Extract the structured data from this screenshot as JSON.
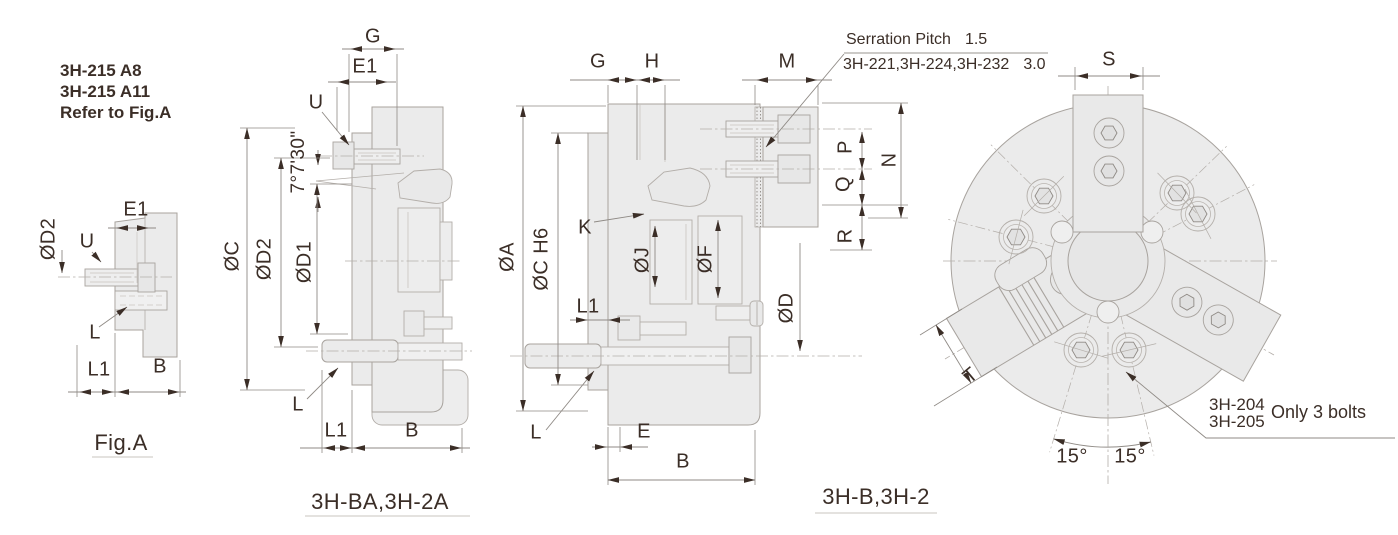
{
  "colors": {
    "ink": "#3b2e27",
    "body_fill": "#ebebeb",
    "outline": "#a8a39e",
    "dim_line": "#8f8a85"
  },
  "note_block": {
    "line1": "3H-215 A8",
    "line2": "3H-215 A11",
    "line3": "Refer to Fig.A"
  },
  "fig_a": {
    "caption": "Fig.A",
    "d2": "ØD2",
    "u": "U",
    "e1": "E1",
    "l": "L",
    "l1": "L1",
    "b": "B"
  },
  "fig_ba": {
    "caption": "3H-BA,3H-2A",
    "g": "G",
    "e1": "E1",
    "u": "U",
    "taper_angle": "7°7'30\"",
    "c": "ØC",
    "d2": "ØD2",
    "d1": "ØD1",
    "l": "L",
    "l1": "L1",
    "b": "B"
  },
  "fig_b": {
    "caption": "3H-B,3H-2",
    "g": "G",
    "h": "H",
    "m": "M",
    "k": "K",
    "a": "ØA",
    "c_h6": "ØC H6",
    "l1": "L1",
    "j": "ØJ",
    "f": "ØF",
    "d": "ØD",
    "p": "P",
    "q": "Q",
    "n": "N",
    "r": "R",
    "l": "L",
    "e": "E",
    "b": "B",
    "serration": {
      "label": "Serration Pitch",
      "pitch": "1.5",
      "models": "3H-221,3H-224,3H-232",
      "models_pitch": "3.0"
    }
  },
  "front_view": {
    "s": "S",
    "t": "T",
    "angle_left": "15°",
    "angle_right": "15°",
    "note_model_1": "3H-204",
    "note_model_2": "3H-205",
    "note_text": "Only 3 bolts"
  }
}
